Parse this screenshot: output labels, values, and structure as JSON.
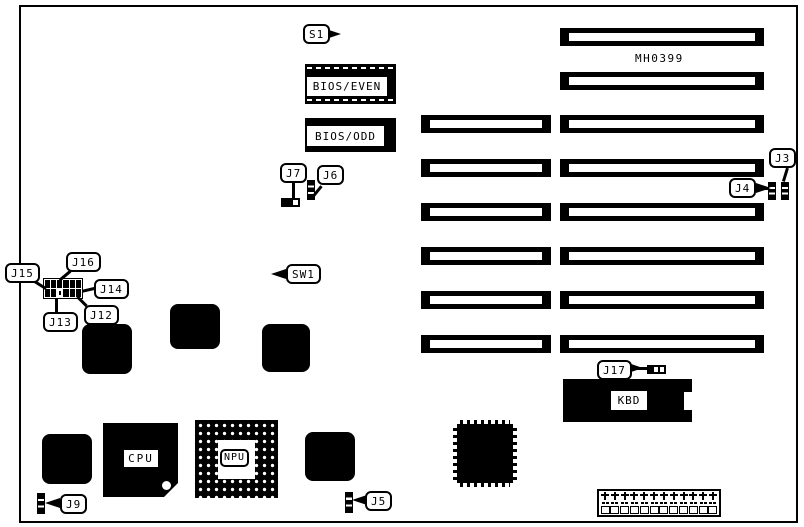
{
  "board": {
    "part_number": "MH0399",
    "type": "motherboard-jumper-diagram",
    "slots": {
      "long_column_count": 8,
      "short_column_count": 6
    },
    "colors": {
      "ink": "#000000",
      "paper": "#ffffff"
    }
  },
  "chips": {
    "bios_even": "BIOS/EVEN",
    "bios_odd": "BIOS/ODD",
    "cpu": "CPU",
    "npu": "NPU",
    "kbd": "KBD"
  },
  "callouts": {
    "s1": "S1",
    "sw1": "SW1",
    "j3": "J3",
    "j4": "J4",
    "j5": "J5",
    "j6": "J6",
    "j7": "J7",
    "j9": "J9",
    "j12": "J12",
    "j13": "J13",
    "j14": "J14",
    "j15": "J15",
    "j16": "J16",
    "j17": "J17"
  }
}
